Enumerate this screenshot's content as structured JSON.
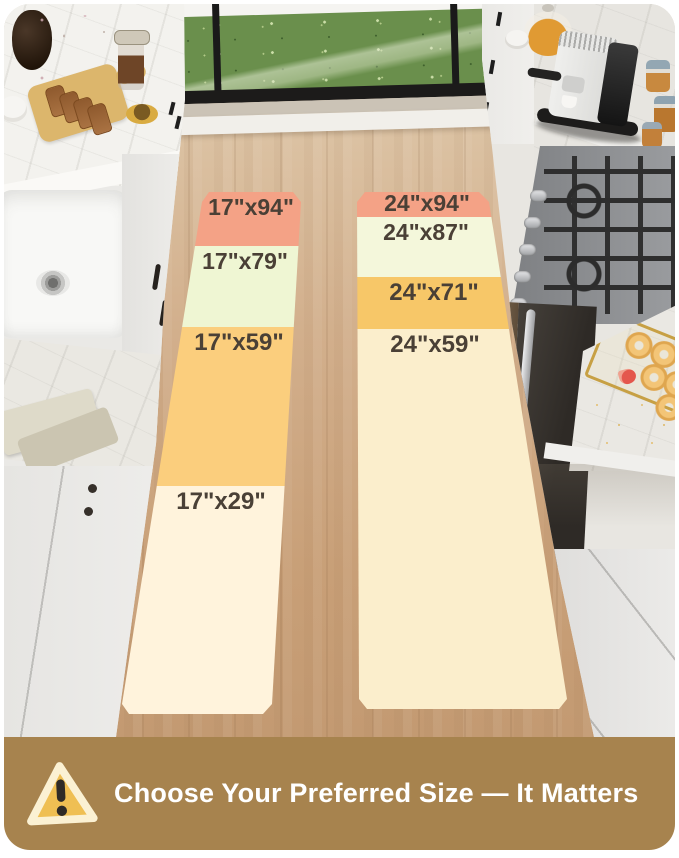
{
  "banner": {
    "label": "Choose Your Preferred Size — It Matters",
    "background": "#A7834E",
    "text_color": "#FFFFFF",
    "icon": "warning-triangle",
    "icon_fill": "#EFBF53",
    "icon_border": "#FBF1D3",
    "icon_mark_color": "#2E2B27"
  },
  "rugs": {
    "label_color": "#4A4036",
    "left": {
      "segments": [
        {
          "label": "17\"x94\"",
          "color": "#F4A286"
        },
        {
          "label": "17\"x79\"",
          "color": "#EFF6D3"
        },
        {
          "label": "17\"x59\"",
          "color": "#FBCE7D"
        },
        {
          "label": "17\"x29\"",
          "color": "#FFF3DC"
        }
      ]
    },
    "right": {
      "segments": [
        {
          "label": "24\"x94\"",
          "color": "#F4A286"
        },
        {
          "label": "24\"x87\"",
          "color": "#F4F7DB"
        },
        {
          "label": "24\"x71\"",
          "color": "#F7C768"
        },
        {
          "label": "24\"x59\"",
          "color": "#FBEECC"
        }
      ]
    }
  }
}
